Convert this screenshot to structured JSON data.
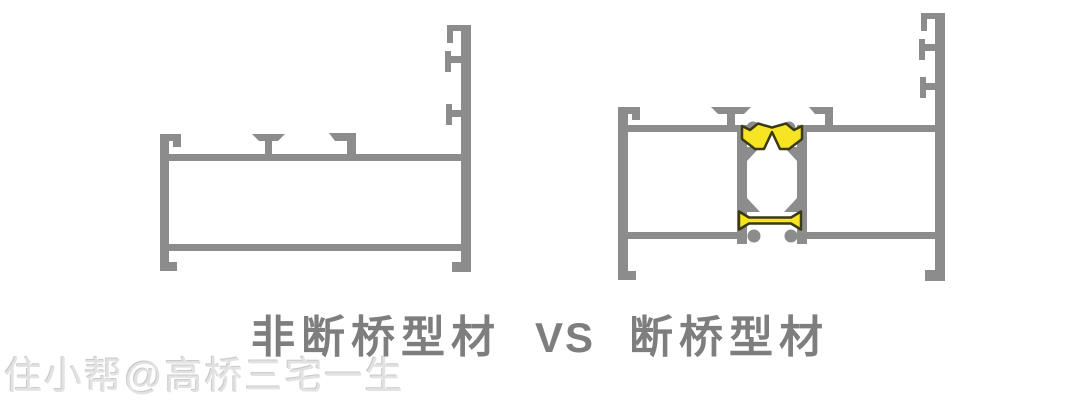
{
  "caption": {
    "left_label": "非断桥型材",
    "separator": "VS",
    "right_label": "断桥型材"
  },
  "watermark": "住小帮@高桥三宅一生",
  "diagram": {
    "left_profile_label": "非断桥型材",
    "right_profile_label": "断桥型材",
    "thermal_strip_count": 2
  },
  "colors": {
    "profile_gray": "#8c8c8c",
    "thermal_yellow": "#f7e523",
    "strip_outline": "#3a3a14",
    "caption_text": "#7e7e7e",
    "watermark_text": "#e2e2e2",
    "background": "#ffffff"
  }
}
